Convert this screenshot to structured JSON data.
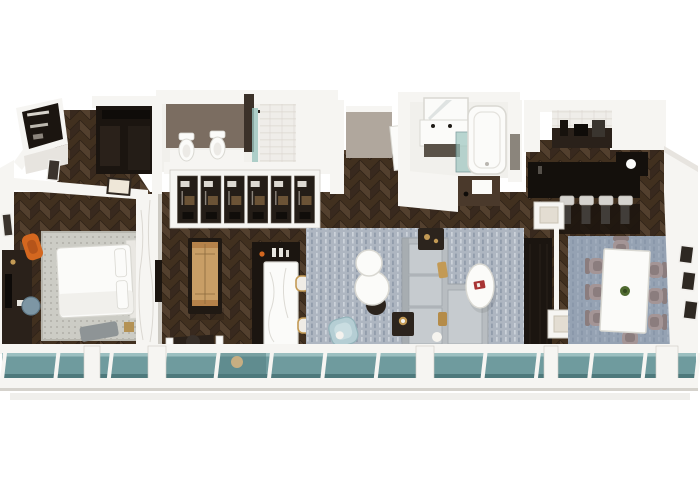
{
  "scene": {
    "type": "3d-floorplan-render",
    "description": "Isometric 3D render of a long hotel suite: entry closet, dressing room, bathroom with toilet and bidet, walk-in wardrobe, bedroom with king bed and desk, lounge with shuffleboard table and wet bar, living room with sectional sofa and round coffee tables, master bathroom with tub and double vanity, kitchen bar with stools, dining room with eight chairs, all fronted by a continuous glass window wall."
  },
  "counts": {
    "window_panes": 13,
    "wardrobe_doors": 6,
    "bar_stools": 4,
    "dining_chairs": 8,
    "toilets": 2,
    "right_wall_frames": 3,
    "coffee_tables": 2
  },
  "colors": {
    "wall": "#f6f5f2",
    "wallShade": "#e7e4df",
    "wallEdge": "#cdcac3",
    "white": "#fbfbf9",
    "whiteEdge": "#d9d8d2",
    "darkUnit": "#1b1510",
    "darkUnit2": "#2a211a",
    "greige": "#b0a79d",
    "brownWall": "#7b6d61",
    "tile": "#efede9",
    "grout": "#dbd7d0",
    "bathFloor": "#f1f0ec",
    "glass": "#6f9b9e",
    "glassHi": "#a3c6c5",
    "glassDark": "#4e797c",
    "showerGlass": "#9cc5bf",
    "wood1": "#53402e",
    "wood2": "#38291e",
    "woodSeam": "#2c2016",
    "rugBed": "#ccccc5",
    "rugBedDot": "#a8a79f",
    "rugLiving": "#aeb6c1",
    "rugLivingHi": "#ccd2da",
    "rugLivingLo": "#8c97a7",
    "rugDining": "#8494a9",
    "sofa": "#b8bdc1",
    "sofaHi": "#c6cbcf",
    "sofaLo": "#9ba1a6",
    "blueChair": "#b5ced4",
    "deskChair": "#7d96a4",
    "orange": "#d4671f",
    "gold": "#c39a55",
    "red": "#a83434",
    "shufWood": "#c89e66",
    "mauve": "#a49596",
    "mauveLo": "#8b7d7e",
    "stoolTop": "#d5d3cf",
    "stoolLeg": "#413d39",
    "green": "#4f6a30",
    "barBlack": "#14100c",
    "tanTable": "#c7ae82"
  }
}
